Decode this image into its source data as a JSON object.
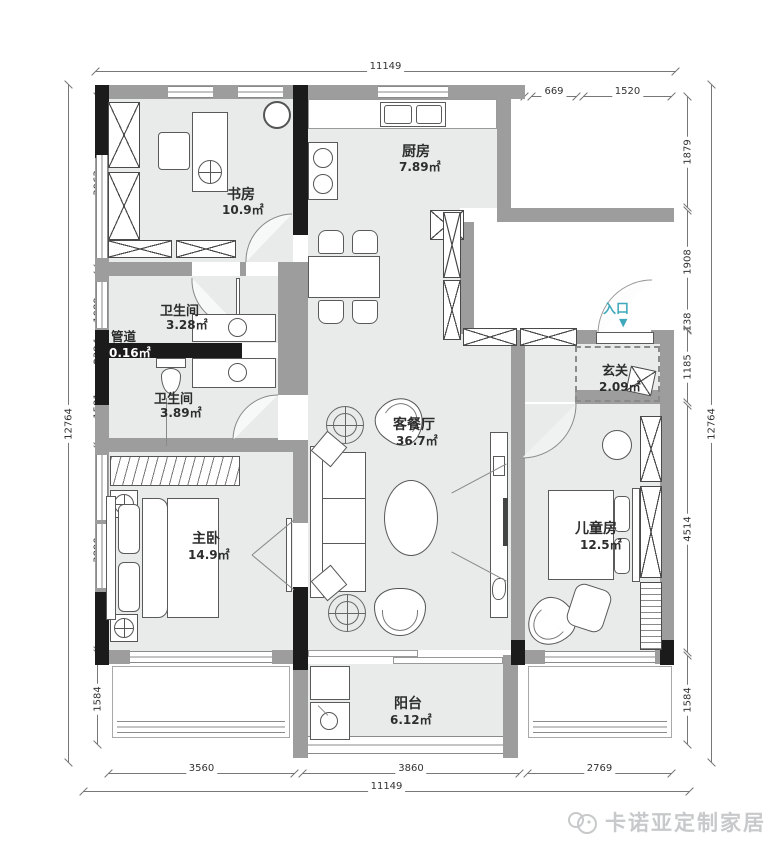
{
  "colors": {
    "wall": "#9d9d9d",
    "column": "#1b1b1b",
    "floor": "#e9ebeb",
    "accent": "#3fa9bc"
  },
  "rooms": {
    "study": {
      "name": "书房",
      "area": "10.9㎡"
    },
    "kitchen": {
      "name": "厨房",
      "area": "7.89㎡"
    },
    "bath1": {
      "name": "卫生间",
      "area": "3.28㎡"
    },
    "duct": {
      "name": "管道",
      "area": "0.16㎡"
    },
    "bath2": {
      "name": "卫生间",
      "area": "3.89㎡"
    },
    "master": {
      "name": "主卧",
      "area": "14.9㎡"
    },
    "living": {
      "name": "客餐厅",
      "area": "36.7㎡"
    },
    "entry": {
      "name": "玄关",
      "area": "2.09㎡"
    },
    "kids": {
      "name": "儿童房",
      "area": "12.5㎡"
    },
    "balcony": {
      "name": "阳台",
      "area": "6.12㎡"
    }
  },
  "entrance": {
    "label": "入口",
    "arrow": "▼"
  },
  "dims": {
    "top": {
      "total": "11149",
      "segs": [
        "3560",
        "4200",
        "669",
        "1520"
      ]
    },
    "bottom": {
      "total": "11149",
      "segs": [
        "3560",
        "3860",
        "2769"
      ]
    },
    "left": {
      "total": "12764",
      "segs": [
        "3063",
        "1089",
        "238",
        "1581",
        "3890",
        "1584"
      ]
    },
    "right": {
      "total": "12764",
      "segs": [
        "1879",
        "1908",
        "138",
        "1185",
        "4514",
        "1584"
      ]
    }
  },
  "watermark": {
    "text": "卡诺亚定制家居"
  }
}
